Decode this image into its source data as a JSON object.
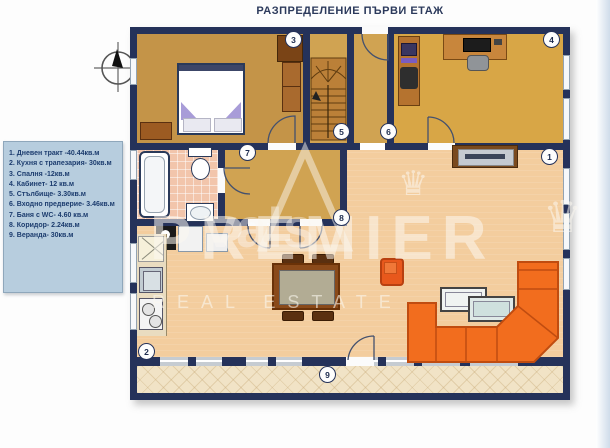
{
  "title": "РАЗПРЕДЕЛЕНИЕ ПЪРВИ ЕТАЖ",
  "legend": {
    "items": [
      "1. Дневен тракт -40.44кв.м",
      "2. Кухня с трапезария- 30кв.м",
      "3. Спалня -12кв.м",
      "4. Кабинет- 12 кв.м",
      "5. Стълбище- 3.30кв.м",
      "6. Входно предверие- 3.46кв.м",
      "7. Баня с WC- 4.60 кв.м",
      "8. Коридор- 2.24кв.м",
      "9. Веранда- 30кв.м"
    ]
  },
  "markers": [
    "1",
    "2",
    "3",
    "4",
    "5",
    "6",
    "7",
    "8",
    "9"
  ],
  "watermark": {
    "brand": "PREMIER",
    "script": "vals",
    "tagline": "REAL ESTATE",
    "crown": "♛"
  },
  "colors": {
    "wall": "#25325a",
    "bedroom_floor": "#c49448",
    "hall_floor": "#d0a352",
    "office_floor": "#d8a646",
    "living_floor": "#f3cd9e",
    "bath_floor": "#f2c5ab",
    "veranda_floor": "#f1e3c6",
    "sofa_orange": "#f26d1e",
    "armchair_orange": "#e8581c",
    "legend_bg": "#b7cdde"
  }
}
